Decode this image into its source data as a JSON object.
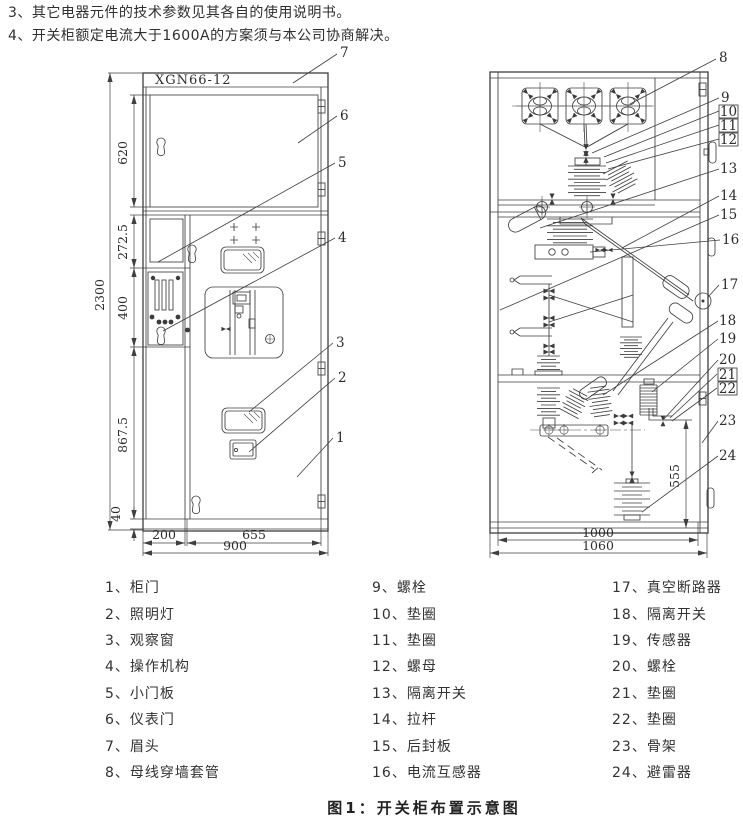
{
  "notes": [
    "3、其它电器元件的技术参数见其各自的使用说明书。",
    "4、开关柜额定电流大于1600A的方案须与本公司协商解决。"
  ],
  "caption": "图1：开关柜布置示意图",
  "front_view": {
    "model_label": "XGN66-12",
    "dims": {
      "overall_height": "2300",
      "meter_door_height": "620",
      "upper_section": "272.5",
      "mech_section": "400",
      "lower_door_height": "867.5",
      "base_height": "40",
      "left_width": "200",
      "door_width": "655",
      "overall_width": "900"
    },
    "callouts": [
      "1",
      "2",
      "3",
      "4",
      "5",
      "6",
      "7"
    ]
  },
  "side_view": {
    "dims": {
      "arrester_height": "555",
      "inner_depth": "1000",
      "overall_depth": "1060"
    },
    "callouts": [
      "8",
      "9",
      "10",
      "11",
      "12",
      "13",
      "14",
      "15",
      "16",
      "17",
      "18",
      "19",
      "20",
      "21",
      "22",
      "23",
      "24"
    ]
  },
  "legend": {
    "col1": [
      "1、柜门",
      "2、照明灯",
      "3、观察窗",
      "4、操作机构",
      "5、小门板",
      "6、仪表门",
      "7、眉头",
      "8、母线穿墙套管"
    ],
    "col2": [
      "9、螺栓",
      "10、垫圈",
      "11、垫圈",
      "12、螺母",
      "13、隔离开关",
      "14、拉杆",
      "15、后封板",
      "16、电流互感器"
    ],
    "col3": [
      "17、真空断路器",
      "18、隔离开关",
      "19、传感器",
      "20、螺栓",
      "21、垫圈",
      "22、垫圈",
      "23、骨架",
      "24、避雷器"
    ]
  }
}
